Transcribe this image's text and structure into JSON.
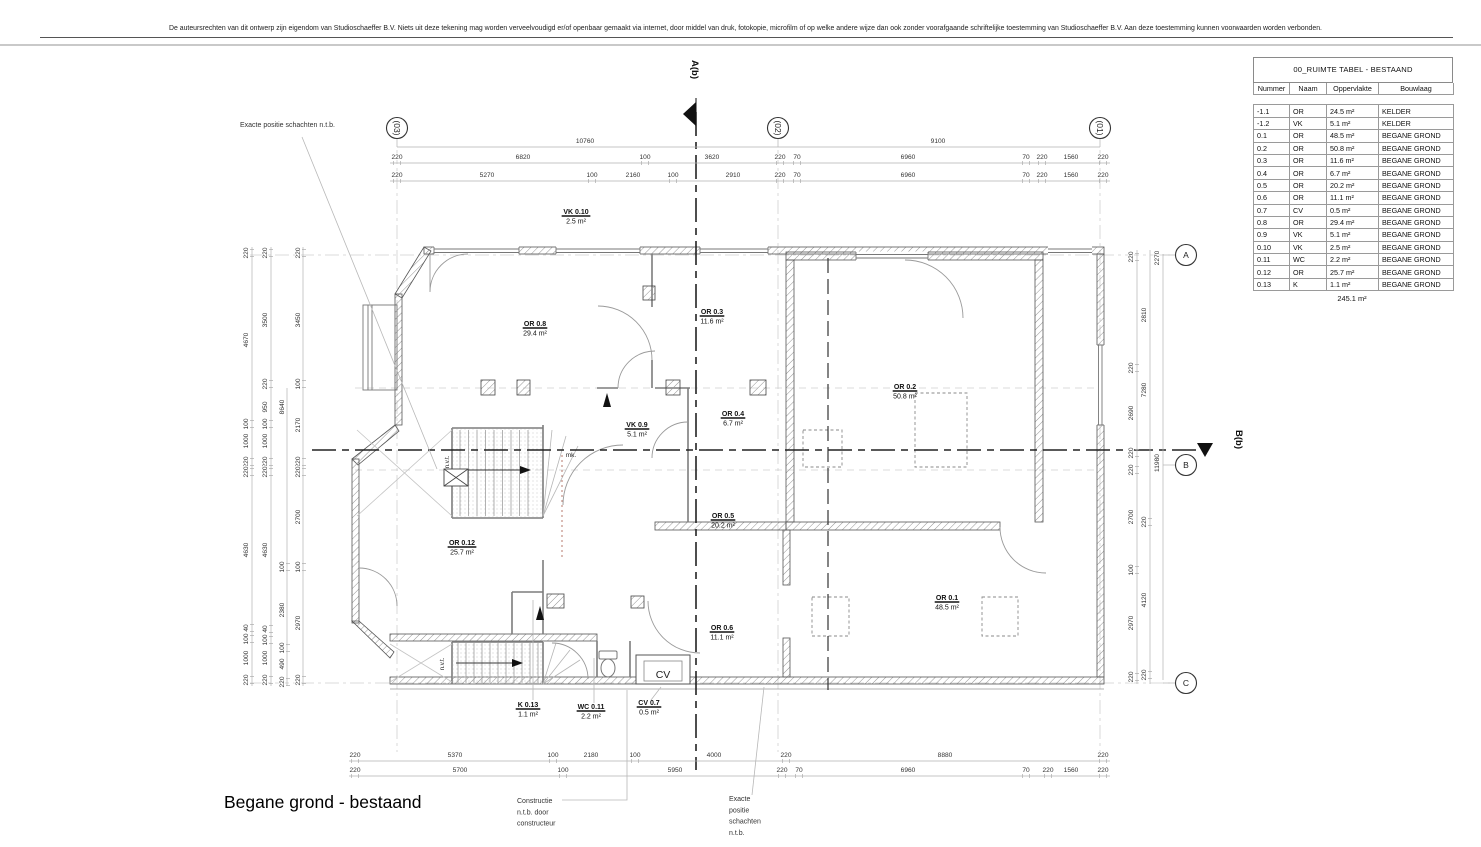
{
  "page": {
    "copyright": "De auteursrechten van dit ontwerp zijn eigendom van Studioschaeffer B.V. Niets uit deze tekening mag worden verveelvoudigd er/of openbaar gemaakt via internet, door middel van druk, fotokopie, microfilm of op welke andere wijze dan ook zonder voorafgaande schriftelijke toestemming van Studioschaeffer B.V. Aan deze toestemming kunnen voorwaarden worden verbonden.",
    "drawing_title": "Begane grond - bestaand"
  },
  "room_table": {
    "title": "00_RUIMTE TABEL - BESTAAND",
    "columns": [
      "Nummer",
      "Naam",
      "Oppervlakte",
      "Bouwlaag"
    ],
    "rows": [
      [
        "-1.1",
        "OR",
        "24.5 m²",
        "KELDER"
      ],
      [
        "-1.2",
        "VK",
        "5.1 m²",
        "KELDER"
      ],
      [
        "0.1",
        "OR",
        "48.5 m²",
        "BEGANE GROND"
      ],
      [
        "0.2",
        "OR",
        "50.8 m²",
        "BEGANE GROND"
      ],
      [
        "0.3",
        "OR",
        "11.6 m²",
        "BEGANE GROND"
      ],
      [
        "0.4",
        "OR",
        "6.7 m²",
        "BEGANE GROND"
      ],
      [
        "0.5",
        "OR",
        "20.2 m²",
        "BEGANE GROND"
      ],
      [
        "0.6",
        "OR",
        "11.1 m²",
        "BEGANE GROND"
      ],
      [
        "0.7",
        "CV",
        "0.5 m²",
        "BEGANE GROND"
      ],
      [
        "0.8",
        "OR",
        "29.4 m²",
        "BEGANE GROND"
      ],
      [
        "0.9",
        "VK",
        "5.1 m²",
        "BEGANE GROND"
      ],
      [
        "0.10",
        "VK",
        "2.5 m²",
        "BEGANE GROND"
      ],
      [
        "0.11",
        "WC",
        "2.2 m²",
        "BEGANE GROND"
      ],
      [
        "0.12",
        "OR",
        "25.7 m²",
        "BEGANE GROND"
      ],
      [
        "0.13",
        "K",
        "1.1 m²",
        "BEGANE GROND"
      ]
    ],
    "total": "245.1 m²"
  },
  "grid_markers": [
    [
      "(03)",
      397,
      128,
      1
    ],
    [
      "(02)",
      778,
      128,
      1
    ],
    [
      "(01)",
      1100,
      128,
      1
    ],
    [
      "A",
      1186,
      255,
      0
    ],
    [
      "B",
      1186,
      465,
      0
    ],
    [
      "C",
      1186,
      683,
      0
    ]
  ],
  "section_markers": [
    [
      "A(b)",
      692,
      60
    ],
    [
      "B(b)",
      1236,
      430
    ]
  ],
  "rooms": [
    [
      "VK 0.10",
      "2.5 m²",
      576,
      214
    ],
    [
      "OR 0.8",
      "29.4 m²",
      535,
      326
    ],
    [
      "OR 0.3",
      "11.6 m²",
      712,
      314
    ],
    [
      "OR 0.2",
      "50.8 m²",
      905,
      389
    ],
    [
      "OR 0.4",
      "6.7 m²",
      733,
      416
    ],
    [
      "VK 0.9",
      "5.1 m²",
      637,
      427
    ],
    [
      "OR 0.5",
      "20.2 m²",
      723,
      518
    ],
    [
      "OR 0.12",
      "25.7 m²",
      462,
      545
    ],
    [
      "OR 0.6",
      "11.1 m²",
      722,
      630
    ],
    [
      "OR 0.1",
      "48.5 m²",
      947,
      600
    ],
    [
      "K 0.13",
      "1.1 m²",
      528,
      707
    ],
    [
      "WC 0.11",
      "2.2 m²",
      591,
      709
    ],
    [
      "CV 0.7",
      "0.5 m²",
      649,
      705
    ]
  ],
  "plan_texts": [
    [
      "CV",
      663,
      678,
      10.5,
      0
    ],
    [
      "mk.",
      571,
      457,
      6.5,
      0
    ],
    [
      "n.v.t.",
      449,
      462,
      6,
      -90
    ],
    [
      "n.v.t.",
      444,
      664,
      6,
      -90
    ]
  ],
  "annotations": [
    {
      "x": 240,
      "y": 127,
      "lines": [
        "Exacte positie schachten n.t.b."
      ]
    },
    {
      "x": 517,
      "y": 803,
      "lines": [
        "Constructie",
        "n.t.b. door",
        "constructeur"
      ]
    },
    {
      "x": 729,
      "y": 801,
      "lines": [
        "Exacte",
        "positie",
        "schachten",
        "n.t.b."
      ]
    }
  ],
  "dims": [
    [
      "10760",
      585,
      143,
      0,
      0
    ],
    [
      "9100",
      938,
      143,
      0,
      0
    ],
    [
      "220",
      397,
      159,
      0,
      1
    ],
    [
      "6820",
      523,
      159,
      0,
      0
    ],
    [
      "100",
      645,
      159,
      0,
      1
    ],
    [
      "3620",
      712,
      159,
      0,
      0
    ],
    [
      "220",
      780,
      159,
      0,
      1
    ],
    [
      "70",
      797,
      159,
      0,
      1
    ],
    [
      "6960",
      908,
      159,
      0,
      0
    ],
    [
      "70",
      1026,
      159,
      0,
      1
    ],
    [
      "220",
      1042,
      159,
      0,
      1
    ],
    [
      "1560",
      1071,
      159,
      0,
      0
    ],
    [
      "220",
      1103,
      159,
      0,
      1
    ],
    [
      "220",
      397,
      177,
      0,
      1
    ],
    [
      "5270",
      487,
      177,
      0,
      0
    ],
    [
      "100",
      592,
      177,
      0,
      1
    ],
    [
      "2160",
      633,
      177,
      0,
      0
    ],
    [
      "100",
      673,
      177,
      0,
      1
    ],
    [
      "2910",
      733,
      177,
      0,
      0
    ],
    [
      "220",
      780,
      177,
      0,
      1
    ],
    [
      "70",
      797,
      177,
      0,
      1
    ],
    [
      "6960",
      908,
      177,
      0,
      0
    ],
    [
      "70",
      1026,
      177,
      0,
      1
    ],
    [
      "220",
      1042,
      177,
      0,
      1
    ],
    [
      "1560",
      1071,
      177,
      0,
      0
    ],
    [
      "220",
      1103,
      177,
      0,
      1
    ],
    [
      "220",
      355,
      757,
      0,
      1
    ],
    [
      "5370",
      455,
      757,
      0,
      0
    ],
    [
      "100",
      553,
      757,
      0,
      1
    ],
    [
      "2180",
      591,
      757,
      0,
      0
    ],
    [
      "100",
      635,
      757,
      0,
      1
    ],
    [
      "4000",
      714,
      757,
      0,
      0
    ],
    [
      "220",
      786,
      757,
      0,
      1
    ],
    [
      "8880",
      945,
      757,
      0,
      0
    ],
    [
      "220",
      1103,
      757,
      0,
      1
    ],
    [
      "220",
      355,
      772,
      0,
      1
    ],
    [
      "5700",
      460,
      772,
      0,
      0
    ],
    [
      "100",
      563,
      772,
      0,
      1
    ],
    [
      "5950",
      675,
      772,
      0,
      0
    ],
    [
      "220",
      782,
      772,
      0,
      1
    ],
    [
      "70",
      799,
      772,
      0,
      1
    ],
    [
      "6960",
      908,
      772,
      0,
      0
    ],
    [
      "70",
      1026,
      772,
      0,
      1
    ],
    [
      "220",
      1048,
      772,
      0,
      1
    ],
    [
      "1560",
      1071,
      772,
      0,
      0
    ],
    [
      "220",
      1103,
      772,
      0,
      1
    ],
    [
      "220",
      248,
      253,
      1,
      1
    ],
    [
      "4670",
      248,
      340,
      1,
      0
    ],
    [
      "100",
      248,
      424,
      1,
      1
    ],
    [
      "1000",
      248,
      441,
      1,
      0
    ],
    [
      "220",
      248,
      462,
      1,
      1
    ],
    [
      "220",
      248,
      472,
      1,
      1
    ],
    [
      "4630",
      248,
      550,
      1,
      0
    ],
    [
      "40",
      248,
      628,
      1,
      1
    ],
    [
      "100",
      248,
      639,
      1,
      1
    ],
    [
      "1000",
      248,
      658,
      1,
      0
    ],
    [
      "220",
      248,
      680,
      1,
      1
    ],
    [
      "220",
      267,
      253,
      1,
      1
    ],
    [
      "3500",
      267,
      320,
      1,
      0
    ],
    [
      "220",
      267,
      384,
      1,
      1
    ],
    [
      "950",
      267,
      407,
      1,
      0
    ],
    [
      "100",
      267,
      424,
      1,
      1
    ],
    [
      "1000",
      267,
      441,
      1,
      0
    ],
    [
      "220",
      267,
      462,
      1,
      1
    ],
    [
      "220",
      267,
      472,
      1,
      1
    ],
    [
      "4630",
      267,
      550,
      1,
      0
    ],
    [
      "40",
      267,
      629,
      1,
      1
    ],
    [
      "100",
      267,
      640,
      1,
      1
    ],
    [
      "1000",
      267,
      658,
      1,
      0
    ],
    [
      "220",
      267,
      680,
      1,
      1
    ],
    [
      "8640",
      284,
      407,
      1,
      0
    ],
    [
      "100",
      284,
      567,
      1,
      1
    ],
    [
      "2380",
      284,
      610,
      1,
      0
    ],
    [
      "100",
      284,
      648,
      1,
      1
    ],
    [
      "490",
      284,
      664,
      1,
      0
    ],
    [
      "220",
      284,
      682,
      1,
      1
    ],
    [
      "220",
      300,
      253,
      1,
      1
    ],
    [
      "3450",
      300,
      320,
      1,
      0
    ],
    [
      "100",
      300,
      384,
      1,
      1
    ],
    [
      "2170",
      300,
      425,
      1,
      0
    ],
    [
      "220",
      300,
      462,
      1,
      1
    ],
    [
      "220",
      300,
      472,
      1,
      1
    ],
    [
      "2700",
      300,
      517,
      1,
      0
    ],
    [
      "100",
      300,
      567,
      1,
      1
    ],
    [
      "2970",
      300,
      623,
      1,
      0
    ],
    [
      "220",
      300,
      680,
      1,
      1
    ],
    [
      "220",
      1133,
      257,
      1,
      1
    ],
    [
      "220",
      1133,
      368,
      1,
      1
    ],
    [
      "2690",
      1133,
      413,
      1,
      0
    ],
    [
      "220",
      1133,
      453,
      1,
      1
    ],
    [
      "220",
      1133,
      470,
      1,
      1
    ],
    [
      "2700",
      1133,
      517,
      1,
      0
    ],
    [
      "100",
      1133,
      570,
      1,
      1
    ],
    [
      "2970",
      1133,
      623,
      1,
      0
    ],
    [
      "220",
      1133,
      677,
      1,
      1
    ],
    [
      "2810",
      1146,
      315,
      1,
      0
    ],
    [
      "7280",
      1146,
      390,
      1,
      0
    ],
    [
      "220",
      1146,
      522,
      1,
      1
    ],
    [
      "4120",
      1146,
      600,
      1,
      0
    ],
    [
      "220",
      1146,
      675,
      1,
      1
    ],
    [
      "2270",
      1159,
      258,
      1,
      0
    ],
    [
      "11980",
      1159,
      463,
      1,
      0
    ]
  ]
}
